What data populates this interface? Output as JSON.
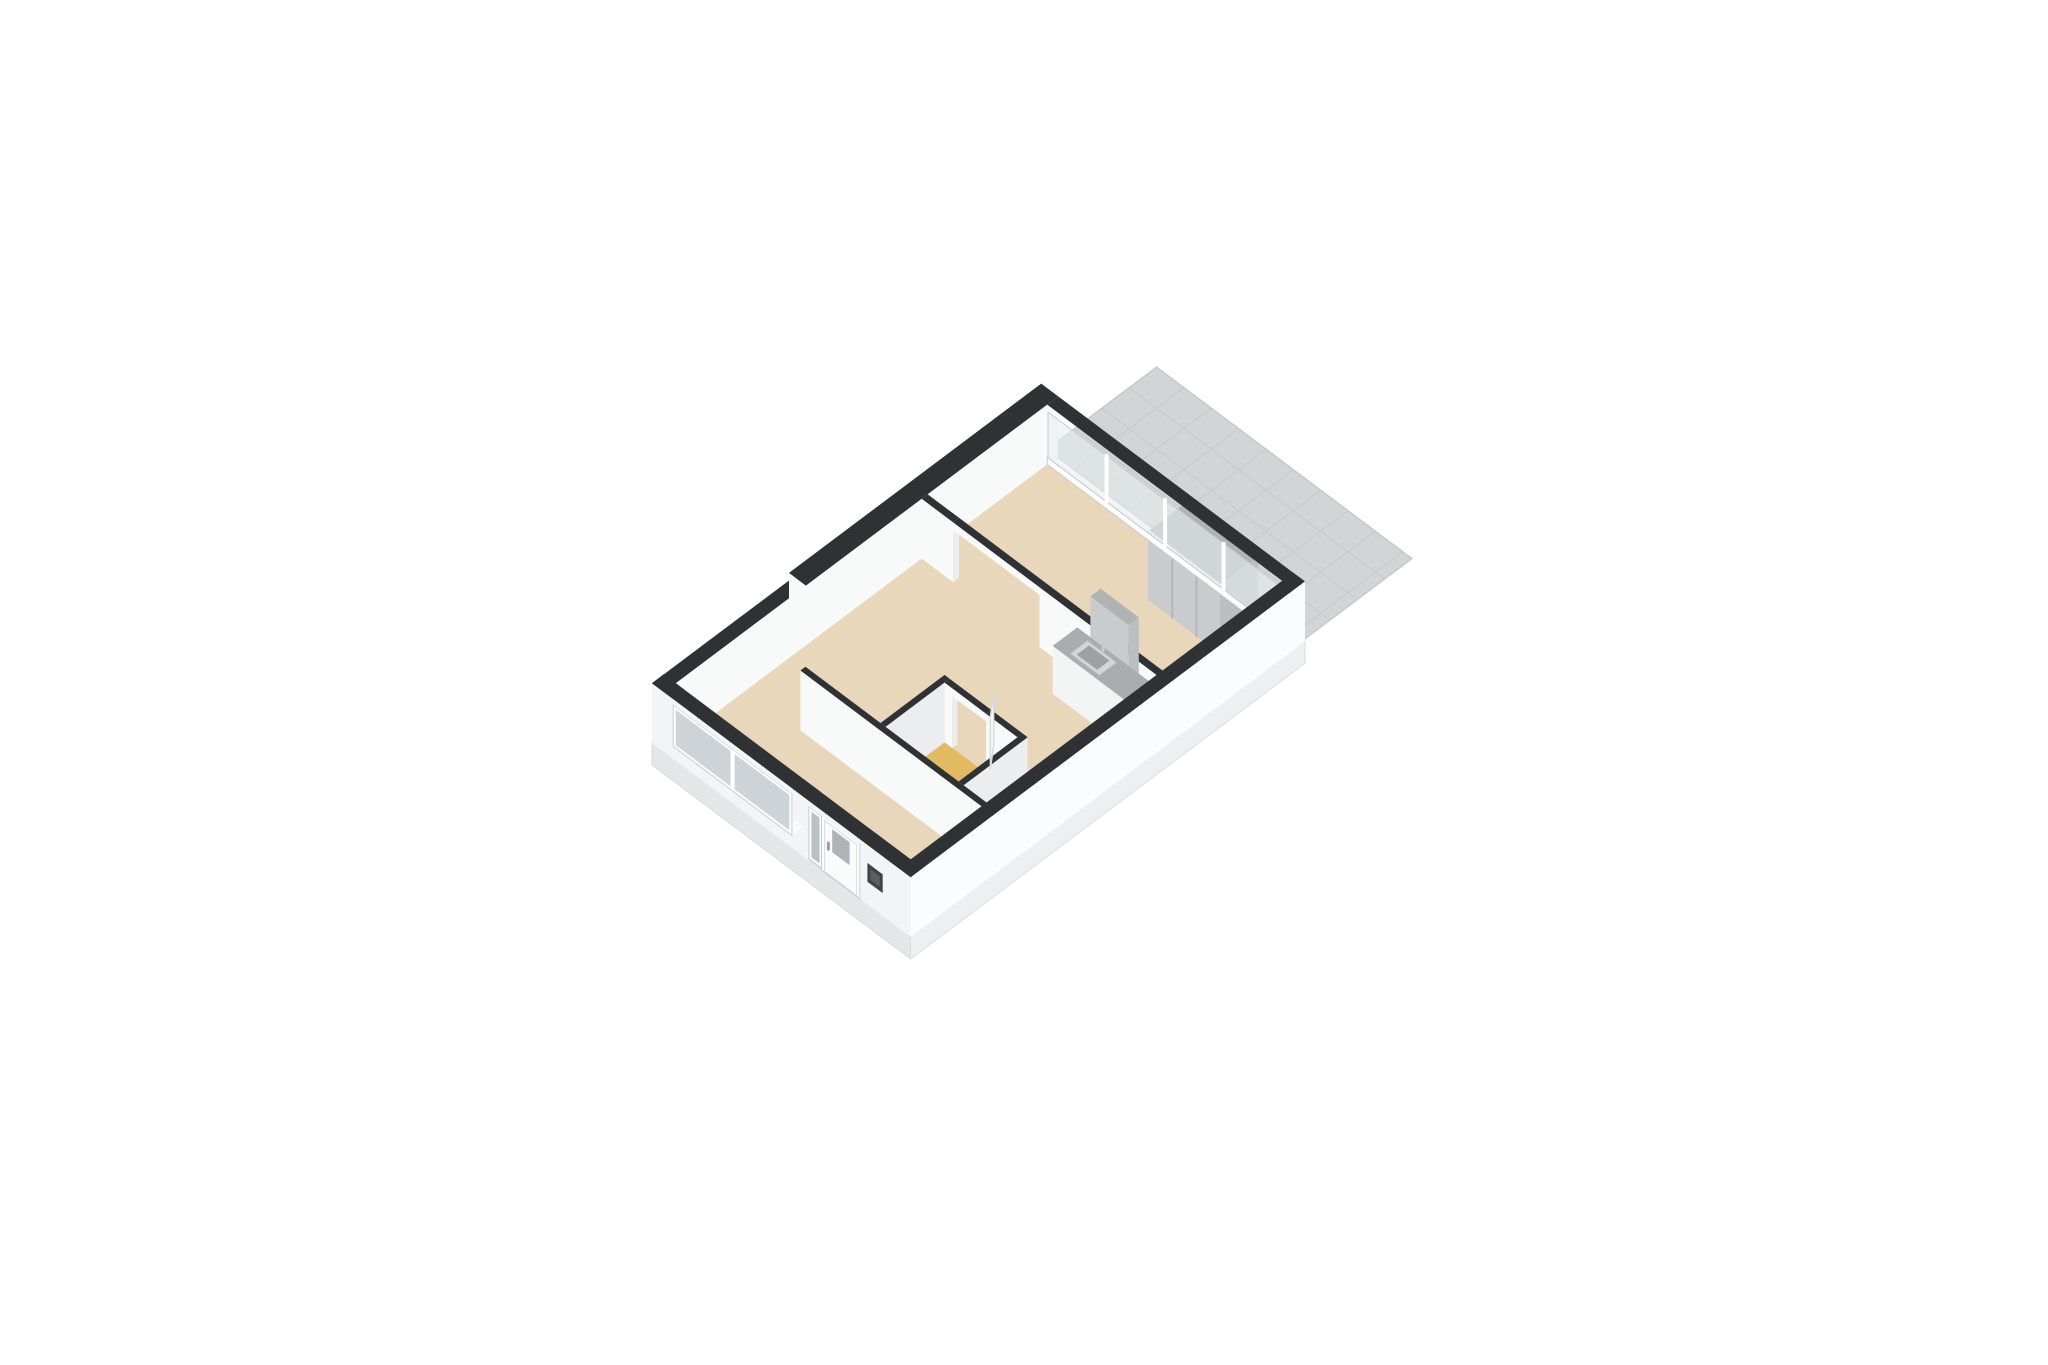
{
  "scene": {
    "canvas": {
      "width": 2048,
      "height": 1365,
      "background": "#ffffff"
    },
    "projection": {
      "ox": 652,
      "oy": 743,
      "ux": 42.4,
      "uy": -31.8,
      "vx": 42.4,
      "vy": 31.8,
      "zz": 52
    },
    "palette": {
      "wallTop": "#2f3234",
      "intA": "#f8f9f9",
      "intB": "#ebedee",
      "extU": "#f3f4f5",
      "extV": "#fbfcfd",
      "plinthU": "#e4e6e7",
      "plinthV": "#edeff0",
      "floor": "#e9d7bb",
      "bath": "#e2ba62",
      "amber": "#d9a751",
      "glass": "#e6edef",
      "glassDark": "#c3ccd0",
      "frame": "#ffffff",
      "frameLine": "#c9cccd",
      "tile": "#d3d4d5",
      "tileLine": "#c7c9c9",
      "counterTop": "#a9adae",
      "sinkRim": "#d3d6d7",
      "sinkBasin": "#9da1a2",
      "grayFront": "#c9cbcc",
      "grayTop": "#b0b3b4",
      "grayDark": "#bcbfc0",
      "leaf": "#fafbfb",
      "leafLine": "#d8dadb",
      "doorGlass": "#adb4b7",
      "panelDark": "#3f4347"
    },
    "rooms": [
      {
        "id": "living-room",
        "floor": "floor"
      },
      {
        "id": "bedroom",
        "floor": "floor"
      },
      {
        "id": "hall",
        "floor": "floor"
      },
      {
        "id": "bathroom",
        "floor": "bath"
      },
      {
        "id": "kitchen",
        "floor": "floor"
      },
      {
        "id": "terrace",
        "floor": "tile"
      }
    ],
    "elements": [
      {
        "name": "terrace-floor",
        "type": "terrace",
        "u1": 9.32,
        "u2": 11.9,
        "v1": 0.0,
        "v2": 6.02,
        "z": -0.05,
        "tile": 0.645,
        "fill": "tile",
        "grid": "tileLine",
        "edge": "tileLine"
      },
      {
        "name": "plinth-left",
        "type": "quadU",
        "at": 0,
        "a1": 0,
        "a2": 6.1,
        "z1": -0.42,
        "z2": 0.02,
        "fill": "plinthU",
        "stroke": "#d8dadb"
      },
      {
        "name": "plinth-right",
        "type": "quadV",
        "at": 6.1,
        "a1": 0,
        "a2": 9.3,
        "z1": -0.42,
        "z2": 0.02,
        "fill": "plinthV",
        "stroke": "#dcdedf"
      },
      {
        "name": "floor-living-room",
        "type": "flat",
        "u1": 0.26,
        "u2": 9.04,
        "v1": 0.26,
        "v2": 5.84,
        "z": 0,
        "fill": "floor"
      },
      {
        "name": "floor-bathroom",
        "type": "flat",
        "u1": 2.0,
        "u2": 3.46,
        "v1": 3.32,
        "v2": 5.16,
        "z": 0.005,
        "fill": "bath"
      },
      {
        "name": "floor-entry-threshold",
        "type": "flat",
        "u1": 0.04,
        "u2": 0.3,
        "v1": 4.02,
        "v2": 4.88,
        "z": 0.005,
        "fill": "amber"
      },
      {
        "name": "wall-north-west-a",
        "type": "wall",
        "u1": 0,
        "u2": 3.35,
        "v1": 0,
        "v2": 0.28,
        "h": 1.15,
        "cu": "extU",
        "cv": "intA"
      },
      {
        "name": "wall-north-west-b",
        "type": "wall",
        "u1": 3.35,
        "u2": 9.3,
        "v1": -0.12,
        "v2": 0.28,
        "h": 1.15,
        "cu": "intA",
        "cv": "intA"
      },
      {
        "name": "bedroom-wardrobe",
        "type": "box",
        "u1": 8.1,
        "u2": 9.0,
        "v1": 3.6,
        "v2": 5.3,
        "h": 1.32,
        "cu": "grayFront",
        "cv": "grayDark",
        "ct": "grayTop"
      },
      {
        "name": "wardrobe-door-seam-1",
        "type": "line",
        "from": [
          8.1,
          4.17,
          0
        ],
        "to": [
          8.1,
          4.17,
          1.32
        ],
        "stroke": "#b4b7b8",
        "w": 2
      },
      {
        "name": "wardrobe-door-seam-2",
        "type": "line",
        "from": [
          8.1,
          4.74,
          0
        ],
        "to": [
          8.1,
          4.74,
          1.32
        ],
        "stroke": "#b4b7b8",
        "w": 2
      },
      {
        "name": "wardrobe-top-rail",
        "type": "line",
        "from": [
          8.1,
          3.6,
          1.32
        ],
        "to": [
          8.1,
          5.3,
          1.32
        ],
        "stroke": "#f2f3f3",
        "w": 3
      },
      {
        "name": "terrace-glass-sill",
        "type": "quadU",
        "at": 9.04,
        "a1": 0.28,
        "a2": 5.84,
        "z1": 0,
        "z2": 0.14,
        "fill": "frame",
        "stroke": "frameLine"
      },
      {
        "name": "terrace-glass-wall",
        "type": "quadU",
        "at": 9.04,
        "a1": 0.3,
        "a2": 5.82,
        "z1": 0.14,
        "z2": 1.02,
        "fill": "glass",
        "op": 0.6,
        "stroke": "frameLine"
      },
      {
        "name": "terrace-glass-mullion-1",
        "type": "line",
        "from": [
          9.04,
          1.68,
          0.14
        ],
        "to": [
          9.04,
          1.68,
          1.02
        ],
        "stroke": "frame",
        "w": 4
      },
      {
        "name": "terrace-glass-mullion-2",
        "type": "line",
        "from": [
          9.04,
          3.06,
          0.14
        ],
        "to": [
          9.04,
          3.06,
          1.02
        ],
        "stroke": "frame",
        "w": 4
      },
      {
        "name": "terrace-glass-mullion-3",
        "type": "line",
        "from": [
          9.04,
          4.44,
          0.14
        ],
        "to": [
          9.04,
          4.44,
          1.02
        ],
        "stroke": "frame",
        "w": 4
      },
      {
        "name": "terrace-glass-end-face",
        "type": "quadV",
        "at": 5.84,
        "a1": 9.04,
        "a2": 9.3,
        "z1": 0,
        "z2": 1.15,
        "fill": "intB"
      },
      {
        "name": "terrace-glass-wall-top",
        "type": "flat",
        "u1": 9.04,
        "u2": 9.3,
        "v1": 0.28,
        "v2": 5.84,
        "z": 1.15,
        "fill": "wallTop"
      },
      {
        "name": "divider-wall-upper",
        "type": "wall",
        "u1": 6.08,
        "u2": 6.22,
        "v1": 0.28,
        "v2": 1.02,
        "h": 1.15,
        "cu": "intA",
        "cv": "intB"
      },
      {
        "name": "divider-opening-lintel",
        "type": "quadU",
        "at": 6.08,
        "a1": 1.02,
        "a2": 3.06,
        "z1": 1.0,
        "z2": 1.15,
        "fill": "intA"
      },
      {
        "name": "divider-opening-top",
        "type": "flat",
        "u1": 6.08,
        "u2": 6.22,
        "v1": 1.02,
        "v2": 3.06,
        "z": 1.15,
        "fill": "wallTop"
      },
      {
        "name": "divider-wall-lower",
        "type": "wall",
        "u1": 6.08,
        "u2": 6.22,
        "v1": 3.06,
        "v2": 5.84,
        "h": 1.15,
        "cu": "intA",
        "cv": "intB"
      },
      {
        "name": "kitchen-tall-unit",
        "type": "box",
        "u1": 5.84,
        "u2": 6.08,
        "v1": 4.5,
        "v2": 5.4,
        "h": 2.0,
        "cu": "grayFront",
        "cv": "grayDark",
        "ct": "grayTop"
      },
      {
        "name": "kitchen-counter",
        "type": "box",
        "u1": 5.5,
        "u2": 6.08,
        "v1": 3.95,
        "v2": 5.84,
        "h": 0.92,
        "cu": "#f3f4f4",
        "cv": "#eceeee",
        "ct": "counterTop"
      },
      {
        "name": "kitchen-sink-rim",
        "type": "flat",
        "u1": 5.58,
        "u2": 5.99,
        "v1": 4.28,
        "v2": 4.97,
        "z": 0.925,
        "fill": "sinkRim",
        "stroke": "#b6b9ba"
      },
      {
        "name": "kitchen-sink-basin",
        "type": "flat",
        "u1": 5.64,
        "u2": 5.93,
        "v1": 4.38,
        "v2": 4.86,
        "z": 0.93,
        "fill": "sinkBasin"
      },
      {
        "name": "kitchen-faucet",
        "type": "line",
        "from": [
          6.02,
          4.62,
          0.92
        ],
        "to": [
          6.02,
          4.62,
          1.08
        ],
        "stroke": "#c7cacb",
        "w": 3
      },
      {
        "name": "bathroom-wall-top",
        "type": "wall",
        "u1": 2.07,
        "u2": 3.58,
        "v1": 3.32,
        "v2": 3.44,
        "h": 1.15,
        "cu": "intA",
        "cv": "intB"
      },
      {
        "name": "bathroom-wall-right-a",
        "type": "wall",
        "u1": 3.46,
        "u2": 3.58,
        "v1": 3.44,
        "v2": 3.62,
        "h": 1.15,
        "cu": "intA",
        "cv": "intB"
      },
      {
        "name": "bathroom-wall-right-b",
        "type": "wall",
        "u1": 3.46,
        "u2": 3.58,
        "v1": 4.42,
        "v2": 5.16,
        "h": 1.15,
        "cu": "intA",
        "cv": "intB"
      },
      {
        "name": "bathroom-door-lintel",
        "type": "quadU",
        "at": 3.46,
        "a1": 3.62,
        "a2": 4.42,
        "z1": 1.0,
        "z2": 1.15,
        "fill": "intA"
      },
      {
        "name": "bathroom-door-top",
        "type": "flat",
        "u1": 3.46,
        "u2": 3.58,
        "v1": 3.62,
        "v2": 4.42,
        "z": 1.15,
        "fill": "wallTop"
      },
      {
        "name": "bathroom-wall-bottom",
        "type": "wall",
        "u1": 2.07,
        "u2": 3.58,
        "v1": 5.16,
        "v2": 5.28,
        "h": 1.15,
        "cu": "intA",
        "cv": "intB"
      },
      {
        "name": "bathroom-door-leaf",
        "type": "doorleaf",
        "A": [
          3.58,
          4.4
        ],
        "B": [
          4.0,
          4.06
        ],
        "z2": 1.0,
        "fill": "leaf",
        "stroke": "leafLine"
      },
      {
        "name": "hall-wall",
        "type": "wall",
        "u1": 1.95,
        "u2": 2.07,
        "v1": 1.55,
        "v2": 5.84,
        "h": 1.15,
        "cu": "intA",
        "cv": "intB"
      },
      {
        "name": "facade-wall-a",
        "type": "wall",
        "u1": 0,
        "u2": 0.28,
        "v1": 0,
        "v2": 0.5,
        "h": 1.15,
        "cu": "extU",
        "cv": "intA"
      },
      {
        "name": "facade-wall-b",
        "type": "wall",
        "u1": 0,
        "u2": 0.28,
        "v1": 3.3,
        "v2": 3.7,
        "h": 1.15,
        "cu": "extU",
        "cv": "intA"
      },
      {
        "name": "facade-wall-c",
        "type": "wall",
        "u1": 0,
        "u2": 0.28,
        "v1": 4.9,
        "v2": 6.1,
        "h": 1.15,
        "cu": "extU",
        "cv": "intA"
      },
      {
        "name": "living-window-sill",
        "type": "quadU",
        "at": 0,
        "a1": 0.5,
        "a2": 3.3,
        "z1": 0,
        "z2": 0.24,
        "fill": "extU"
      },
      {
        "name": "living-window-sill-top",
        "type": "flat",
        "u1": 0,
        "u2": 0.28,
        "v1": 0.5,
        "v2": 3.3,
        "z": 0.24,
        "fill": "#fafafa"
      },
      {
        "name": "living-window-frame",
        "type": "quadU",
        "at": 0,
        "a1": 0.5,
        "a2": 3.3,
        "z1": 0.24,
        "z2": 1.04,
        "fill": "frame",
        "stroke": "frameLine"
      },
      {
        "name": "living-window-glass",
        "type": "quadU",
        "at": 0,
        "a1": 0.56,
        "a2": 3.24,
        "z1": 0.3,
        "z2": 0.98,
        "fill": "glassDark",
        "op": 0.85
      },
      {
        "name": "living-window-mullion",
        "type": "line",
        "from": [
          0,
          1.9,
          0.3
        ],
        "to": [
          0,
          1.9,
          0.98
        ],
        "stroke": "frame",
        "w": 4
      },
      {
        "name": "entry-sidelight-frame",
        "type": "quadU",
        "at": 0,
        "a1": 3.7,
        "a2": 4.0,
        "z1": 0.04,
        "z2": 1.04,
        "fill": "frame",
        "stroke": "frameLine"
      },
      {
        "name": "entry-sidelight-glass",
        "type": "quadU",
        "at": 0,
        "a1": 3.76,
        "a2": 3.95,
        "z1": 0.1,
        "z2": 0.98,
        "fill": "#b9c1c4"
      },
      {
        "name": "entry-door-frame",
        "type": "quadU",
        "at": 0,
        "a1": 4.0,
        "a2": 4.9,
        "z1": 0,
        "z2": 1.06,
        "fill": "frame",
        "stroke": "frameLine"
      },
      {
        "name": "entry-door-leaf",
        "type": "quadU",
        "at": 0,
        "a1": 4.07,
        "a2": 4.83,
        "z1": 0.02,
        "z2": 1.0,
        "fill": "leaf",
        "stroke": "leafLine"
      },
      {
        "name": "entry-door-glass",
        "type": "quadU",
        "at": 0,
        "a1": 4.25,
        "a2": 4.66,
        "z1": 0.5,
        "z2": 0.94,
        "fill": "doorGlass"
      },
      {
        "name": "entry-door-handle",
        "type": "line",
        "from": [
          0,
          4.16,
          0.5
        ],
        "to": [
          0,
          4.16,
          0.62
        ],
        "stroke": "#9aa0a3",
        "w": 3
      },
      {
        "name": "facade-lintel",
        "type": "quadU",
        "at": 0,
        "a1": 0.5,
        "a2": 4.9,
        "z1": 1.04,
        "z2": 1.15,
        "fill": "extU"
      },
      {
        "name": "intercom-panel",
        "type": "quadU",
        "at": 0,
        "a1": 5.08,
        "a2": 5.44,
        "z1": 0.44,
        "z2": 0.8,
        "fill": "panelDark"
      },
      {
        "name": "intercom-panel-inner",
        "type": "quadU",
        "at": 0,
        "a1": 5.15,
        "a2": 5.37,
        "z1": 0.52,
        "z2": 0.72,
        "fill": "#5a5f62"
      },
      {
        "name": "facade-wall-top",
        "type": "flat",
        "u1": 0,
        "u2": 0.28,
        "v1": 0,
        "v2": 6.1,
        "z": 1.15,
        "fill": "wallTop"
      },
      {
        "name": "wall-south-east",
        "type": "wall",
        "u1": 0,
        "u2": 9.3,
        "v1": 5.82,
        "v2": 6.1,
        "h": 1.15,
        "cu": "extU",
        "cv": "extV"
      }
    ]
  }
}
